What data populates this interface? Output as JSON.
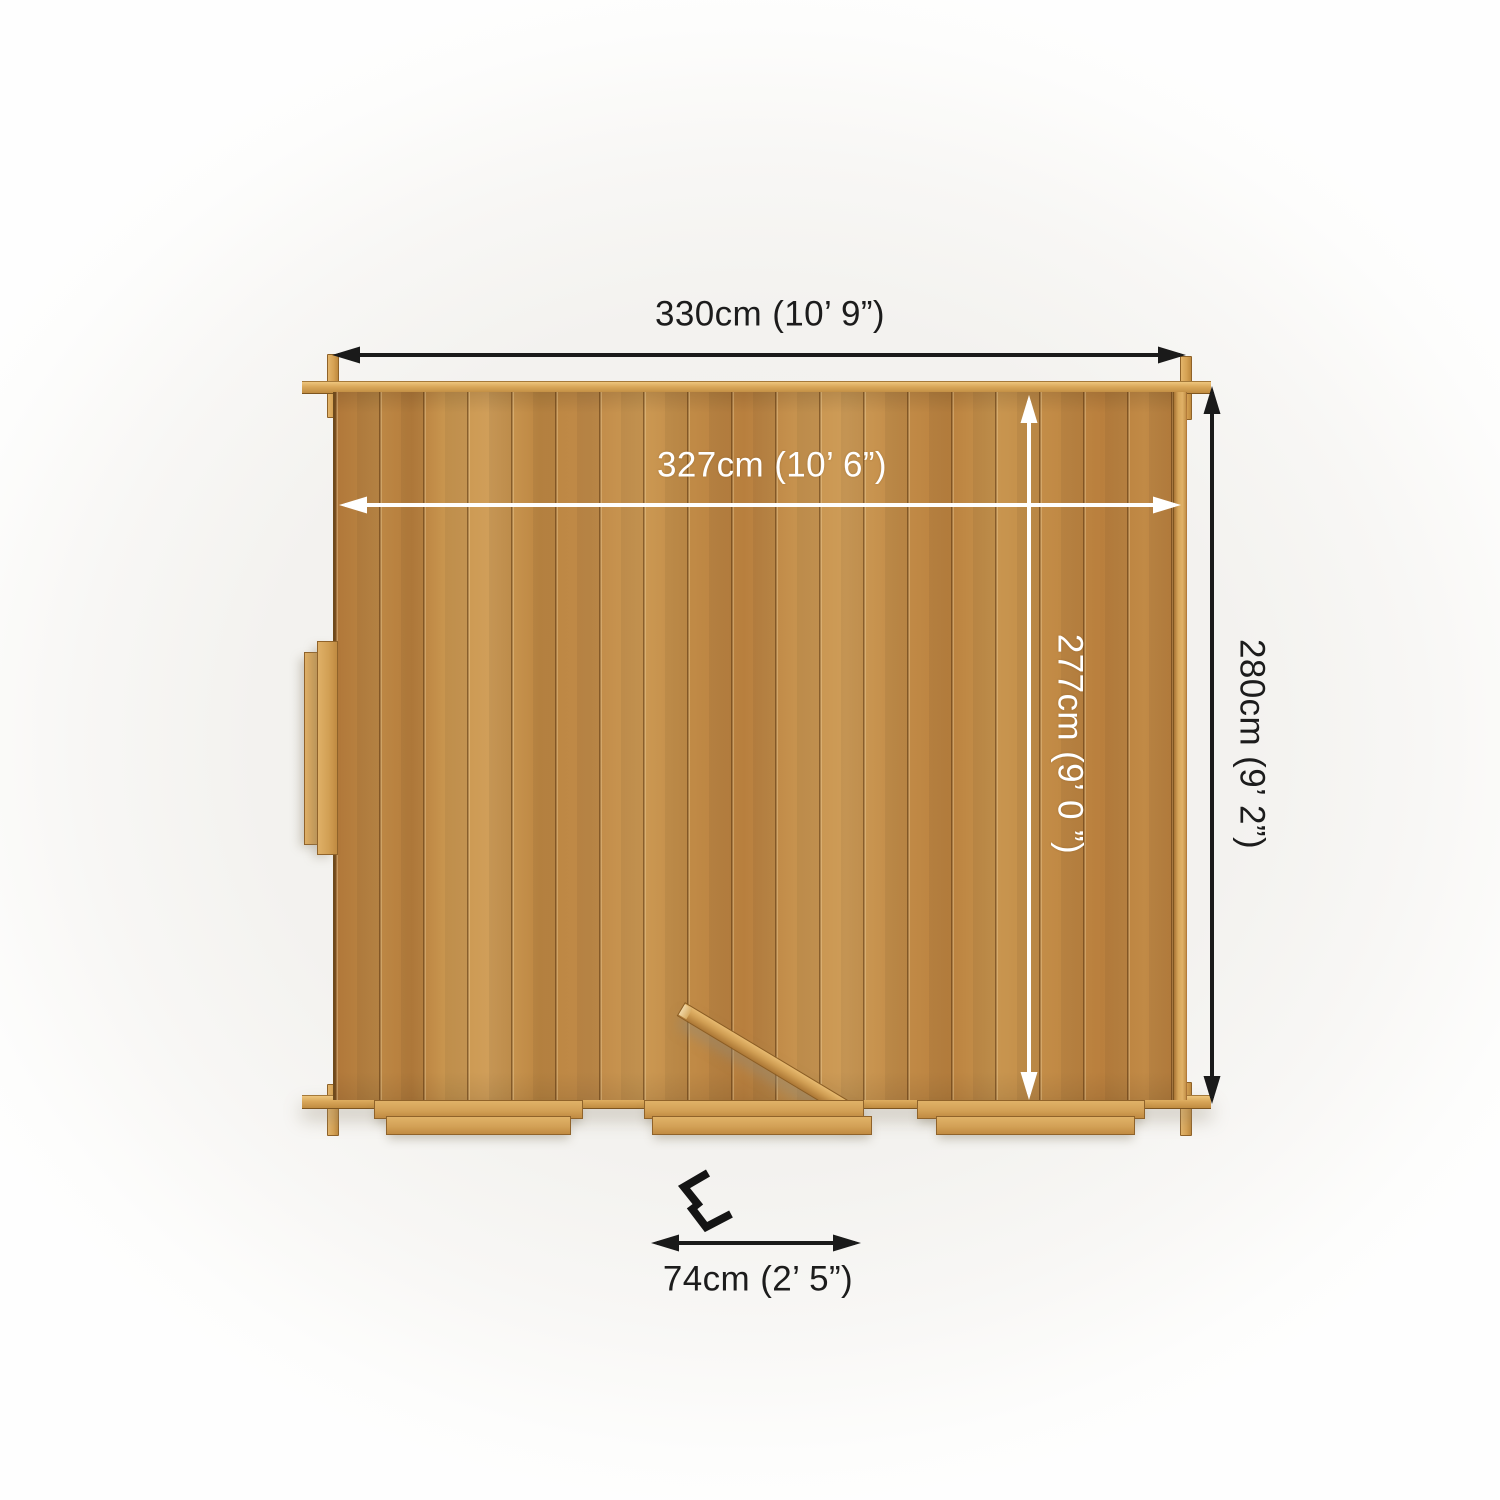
{
  "scene": {
    "background_color": "#f3f2ef",
    "view": "top-down dimension diagram of a wooden log cabin"
  },
  "cabin": {
    "wood_color": "#c08a4a",
    "trim_color": "#d8a558",
    "door_state": "open"
  },
  "dimensions": {
    "outer_width": {
      "label": "330cm (10’ 9”)",
      "color": "#1a1a1a"
    },
    "inner_width": {
      "label": "327cm (10’ 6”)",
      "color": "#ffffff"
    },
    "inner_depth": {
      "label": "277cm (9’ 0 ”)",
      "color": "#ffffff"
    },
    "outer_depth": {
      "label": "280cm (9’ 2”)",
      "color": "#1a1a1a"
    },
    "door_width": {
      "label": "74cm (2’ 5”)",
      "color": "#1a1a1a"
    }
  }
}
